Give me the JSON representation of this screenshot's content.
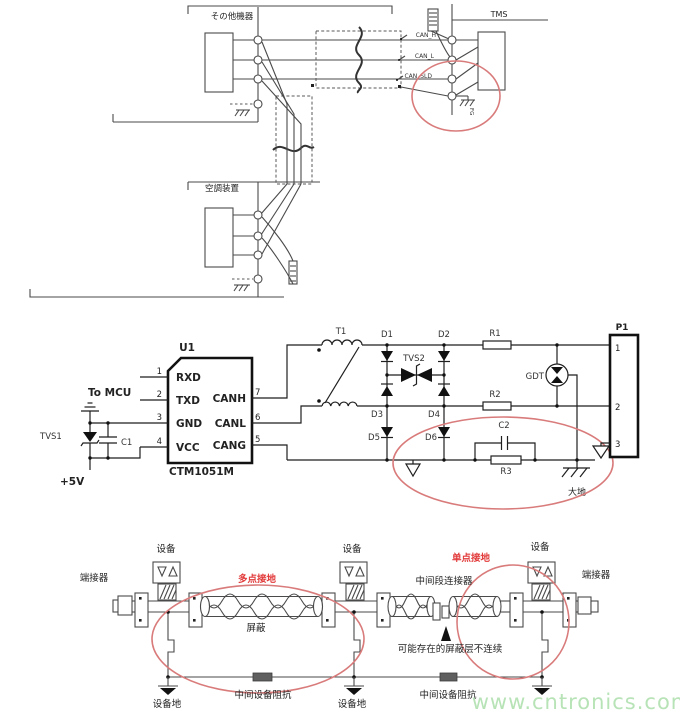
{
  "watermark": {
    "text": "www.cntronics.com",
    "color": "#b7e3b7"
  },
  "colors": {
    "wire": "#4a4a4a",
    "schematic": "#1f1f1f",
    "highlight_ellipse": "#d97b7b",
    "annotation_red": "#e23b3b"
  },
  "top_diagram": {
    "left_device": "その他機器",
    "right_device": "TMS",
    "bottom_device": "空調装置",
    "wire_labels": [
      "CAN_H",
      "CAN_L",
      "CAN_SLD"
    ],
    "ground_label": "FG"
  },
  "middle_schematic": {
    "u1_ref": "U1",
    "u1_part": "CTM1051M",
    "to_mcu": "To MCU",
    "pins_left": [
      {
        "num": "1",
        "name": "RXD"
      },
      {
        "num": "2",
        "name": "TXD"
      },
      {
        "num": "3",
        "name": "GND"
      },
      {
        "num": "4",
        "name": "VCC"
      }
    ],
    "pins_right": [
      {
        "num": "7",
        "name": "CANH"
      },
      {
        "num": "6",
        "name": "CANL"
      },
      {
        "num": "5",
        "name": "CANG"
      }
    ],
    "tvs1": "TVS1",
    "c1": "C1",
    "supply": "+5V",
    "t1": "T1",
    "d1": "D1",
    "d2": "D2",
    "d3": "D3",
    "d4": "D4",
    "d5": "D5",
    "d6": "D6",
    "tvs2": "TVS2",
    "r1": "R1",
    "r2": "R2",
    "r3": "R3",
    "c2": "C2",
    "gdt": "GDT",
    "p1_ref": "P1",
    "p1_pins": [
      "1",
      "2",
      "3"
    ],
    "earth": "大地"
  },
  "bottom_diagram": {
    "terminator_left": "端接器",
    "terminator_right": "端接器",
    "devices": [
      "设备",
      "设备",
      "设备"
    ],
    "multi_point_ground": "多点接地",
    "single_point_ground": "单点接地",
    "mid_segment_connector": "中间段连接器",
    "shield": "屏蔽",
    "shield_discontinuity": "可能存在的屏蔽层不连续",
    "device_grounds": [
      "设备地",
      "设备地"
    ],
    "impedances": [
      "中间设备阻抗",
      "中间设备阻抗"
    ]
  }
}
